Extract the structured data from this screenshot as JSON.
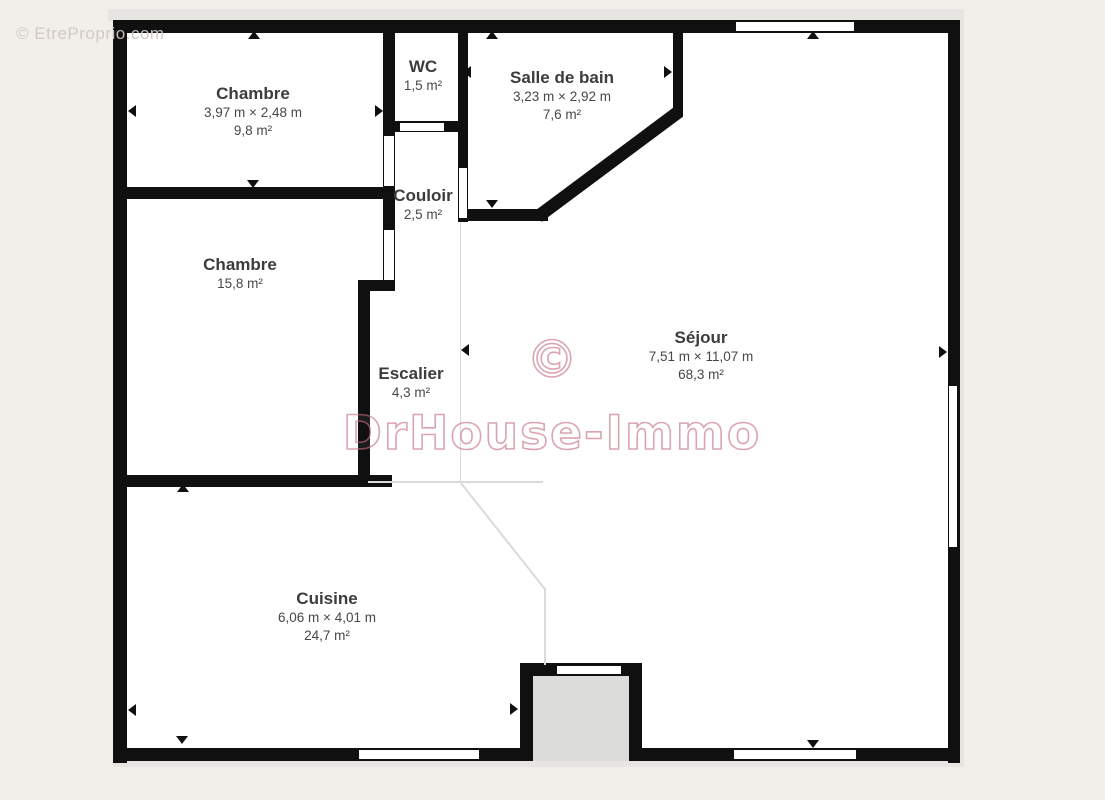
{
  "watermarks": {
    "corner": "© EtreProprio.com",
    "center_symbol": "©",
    "brand": "DrHouse-Immo"
  },
  "colors": {
    "background": "#f2efeb",
    "wall": "#101010",
    "interior": "#ffffff",
    "porch_gray": "#dcdcda",
    "separator_line": "#dadada",
    "label_text": "#3c3c3c",
    "watermark_pink": "#c46e7f",
    "watermark_gray": "#cdc8c0"
  },
  "markers": {
    "opening_arrow_icon": "black triangle",
    "window_icon": "white bar inset in wall",
    "door_icon": "white gap in wall"
  },
  "rooms": [
    {
      "name": "Chambre",
      "dimensions": "3,97 m × 2,48 m",
      "area": "9,8 m²"
    },
    {
      "name": "WC",
      "area": "1,5 m²"
    },
    {
      "name": "Salle de bain",
      "dimensions": "3,23 m × 2,92 m",
      "area": "7,6 m²"
    },
    {
      "name": "Couloir",
      "area": "2,5 m²"
    },
    {
      "name": "Chambre",
      "area": "15,8 m²"
    },
    {
      "name": "Escalier",
      "area": "4,3 m²"
    },
    {
      "name": "Séjour",
      "dimensions": "7,51 m × 11,07 m",
      "area": "68,3 m²"
    },
    {
      "name": "Cuisine",
      "dimensions": "6,06 m × 4,01 m",
      "area": "24,7 m²"
    }
  ]
}
